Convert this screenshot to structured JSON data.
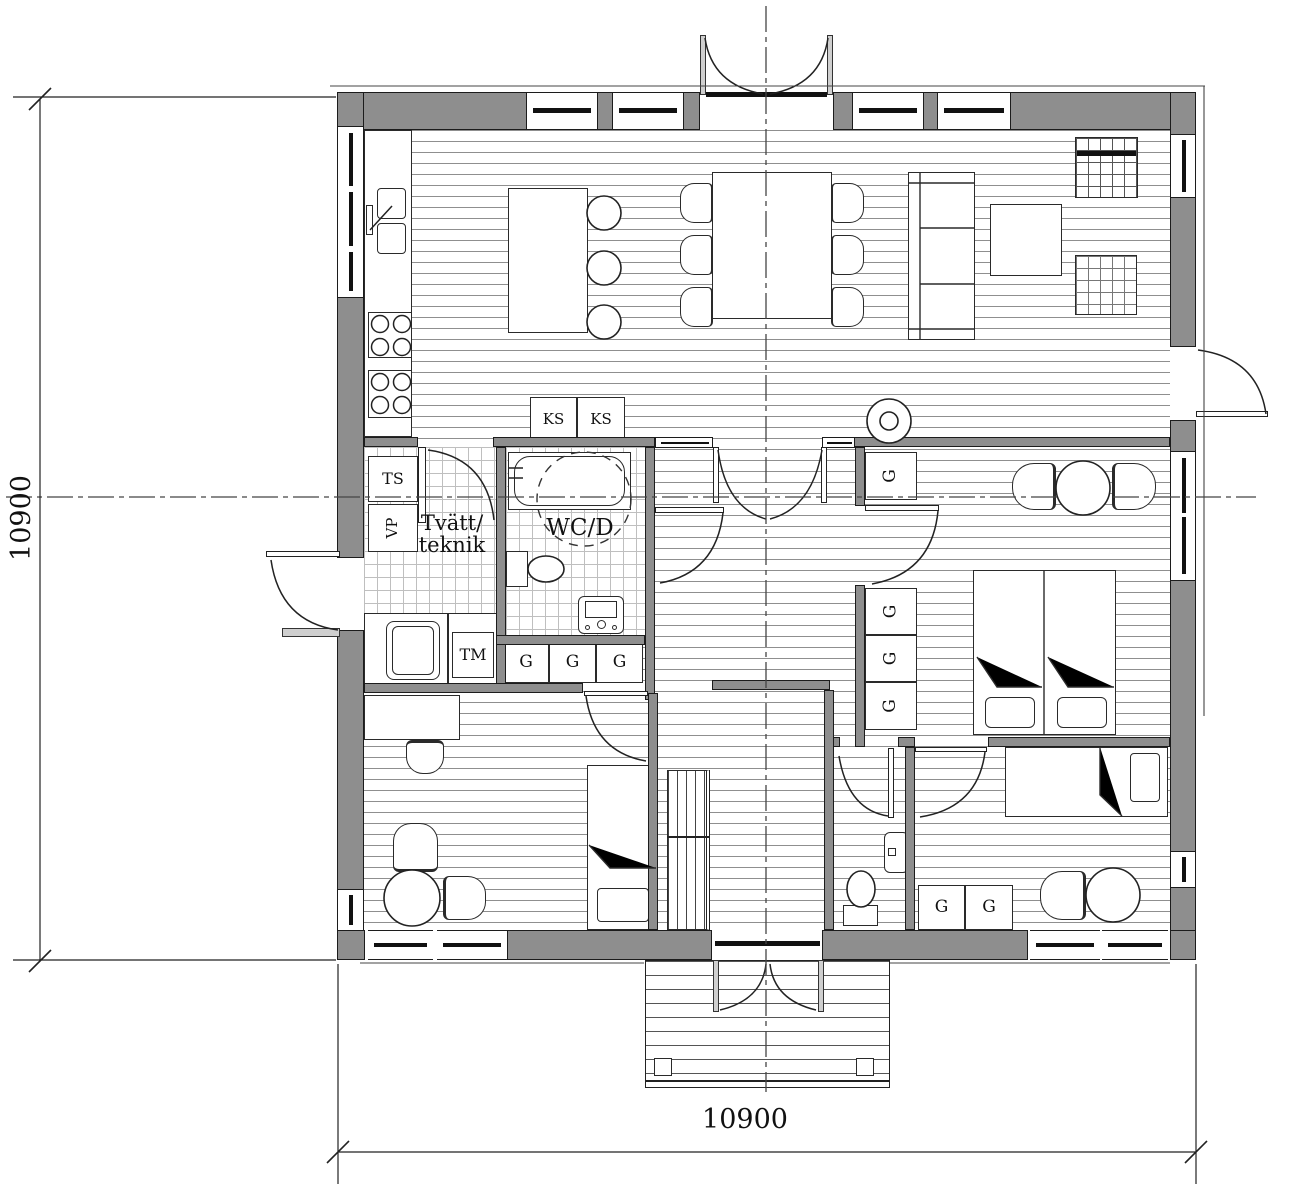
{
  "labels": {
    "laundry_room_l1": "Tvätt/",
    "laundry_room_l2": "teknik",
    "wc_room": "WC/D",
    "fridge": "KS",
    "drying_cabinet": "TS",
    "heat_pump": "VP",
    "washing_machine": "TM",
    "wardrobe": "G",
    "dim_width": "10900",
    "dim_height": "10900"
  }
}
